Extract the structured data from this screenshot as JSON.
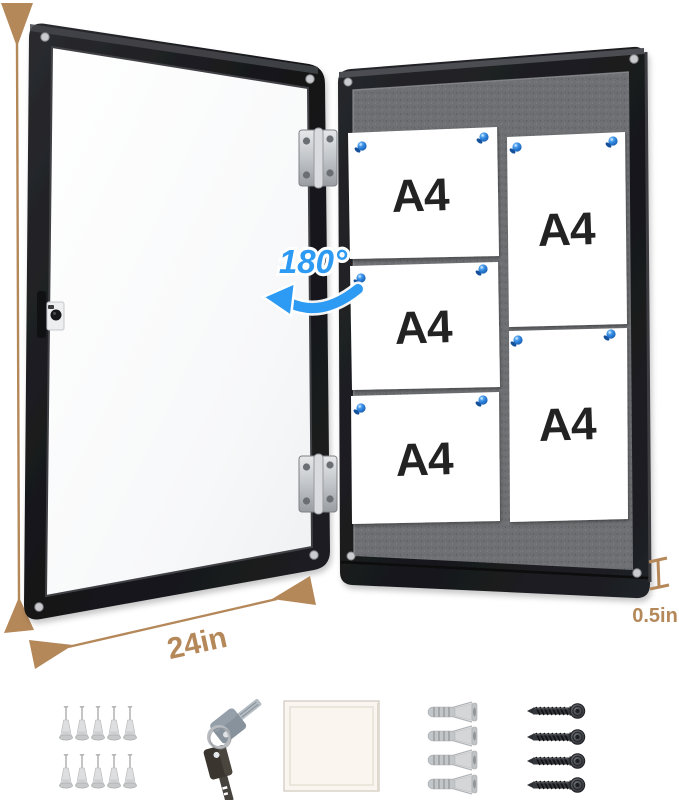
{
  "annotations": {
    "height_label": "36in",
    "width_label": "24in",
    "depth_label": "0.5in",
    "rotation_label": "180°"
  },
  "board": {
    "papers": [
      {
        "label": "A4"
      },
      {
        "label": "A4"
      },
      {
        "label": "A4"
      },
      {
        "label": "A4"
      },
      {
        "label": "A4"
      }
    ]
  },
  "accessories": {
    "push_pins_count": 10,
    "keys_count": 2,
    "paper_pad_count": 1,
    "wall_anchors_count": 4,
    "screws_count": 4,
    "icons": [
      "clear-push-pins",
      "key-set",
      "paper-pad",
      "wall-anchors",
      "screws"
    ]
  },
  "colors": {
    "dimension_tan": "#b5885a",
    "accent_blue": "#2d9bf3",
    "frame_black": "#1b1c1f",
    "felt_gray": "#6f7074",
    "pin_blue": "#2a7fd8",
    "paper_white": "#ffffff"
  }
}
